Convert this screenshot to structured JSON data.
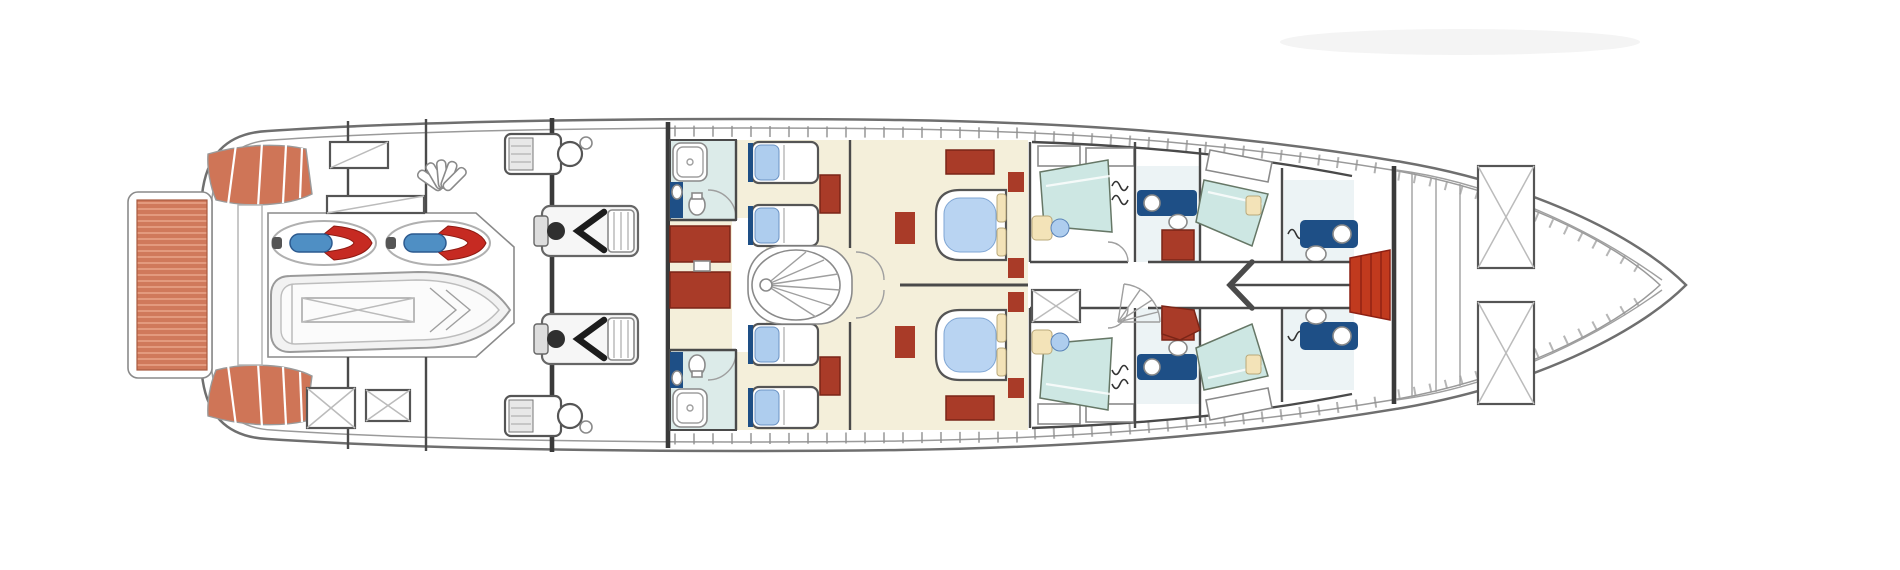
{
  "diagram": {
    "kind": "yacht-lower-deck-floor-plan",
    "orientation": "bow-right"
  },
  "colors": {
    "teak": "#d0795b",
    "teak_stripe": "#e39a7e",
    "stair_teak": "#cf7557",
    "furniture_red": "#a93b28",
    "furniture_red_dark": "#7a2517",
    "steps_red": "#c13a1e",
    "jetski_red": "#c62a22",
    "seat_blue": "#4f8fc4",
    "navy": "#1e4f86",
    "bed_blue": "#aecdee",
    "duvet_blue": "#b9d4f2",
    "teal_room": "#dcebe9",
    "teal_bed": "#cde7e3",
    "cream_floor": "#f4efda",
    "cream_pillow": "#f3e3b8",
    "pale_bath": "#ecf3f5",
    "hull_white": "#ffffff"
  },
  "inventory": {
    "swim_platforms": 1,
    "stern_stair_fans": 2,
    "jet_skis": 2,
    "tenders": 1,
    "main_engines": 2,
    "generators": 2,
    "aft_deck_hatches": 4,
    "twin_guest_cabins": 2,
    "twin_guest_beds": 4,
    "double_guest_cabins": 2,
    "double_beds": 2,
    "spiral_staircases": 1,
    "crew_berths": 4,
    "bathrooms": 6,
    "bow_locker_hatches": 2
  }
}
